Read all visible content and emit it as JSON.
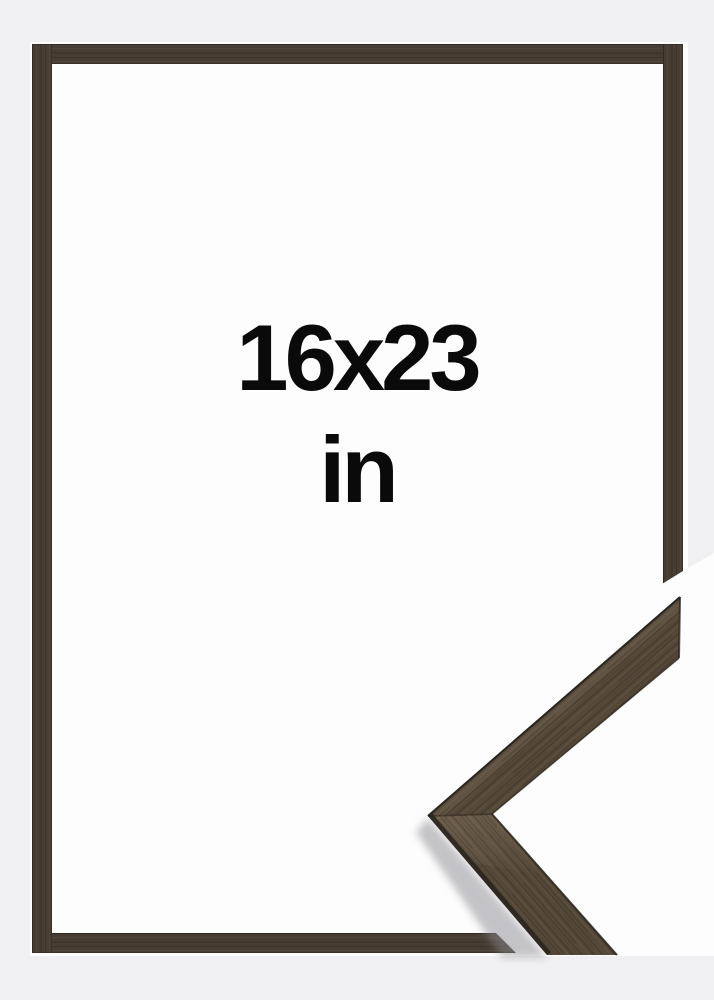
{
  "product_image": {
    "description": "picture frame product photo with corner profile detail",
    "size_label": {
      "line1": "16x23",
      "line2": "in"
    },
    "colors": {
      "page_background": "#f0f0f2",
      "photo_background": "#fdfdfd",
      "wood_base": "#473d33",
      "wood_base_detail": "#544839",
      "wood_light": "#6f6150",
      "wood_edge_dark": "#2a241e",
      "label_text": "#0a0a0a"
    }
  }
}
